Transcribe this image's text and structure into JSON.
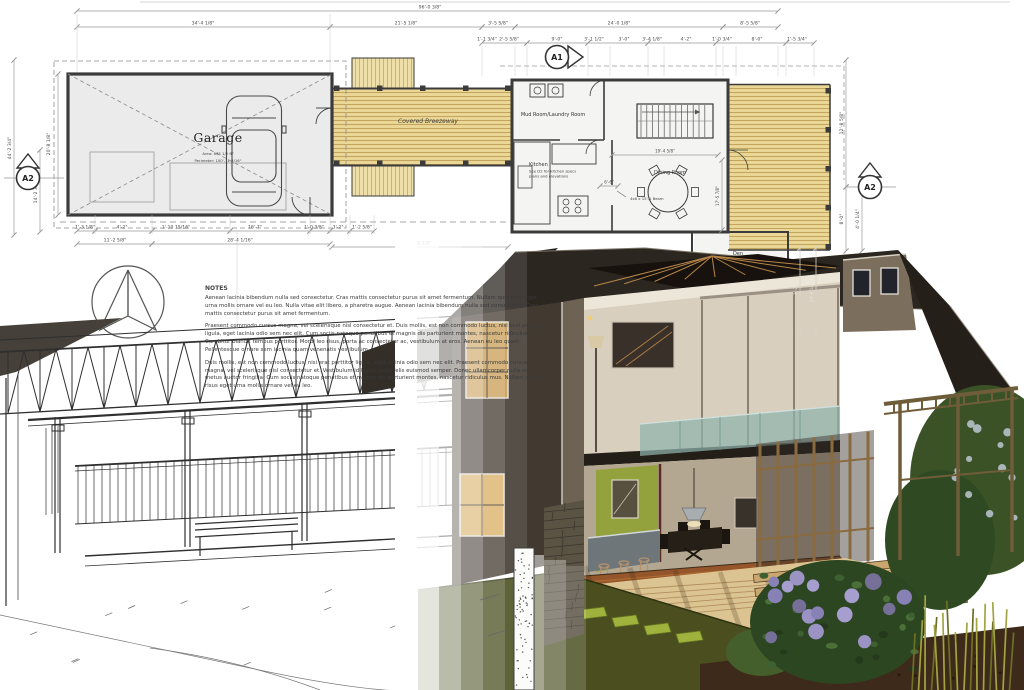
{
  "title": "Residential design: floor plan, construction sketch and 3D section render",
  "plan": {
    "garage": {
      "label": "Garage",
      "area": "Area: 635 1/2 ft²",
      "perimeter": "Perimeter: 100'-11 3/16\""
    },
    "breezeway_label": "Covered Breezeway",
    "rooms": {
      "mudroom": "Mud Room/Laundry Room",
      "kitchen": "Kitchen",
      "kitchen_note1": "See D2 for kitchen specs",
      "kitchen_note2": "plans and elevations",
      "dining": "Dining Room",
      "den": "Den"
    },
    "beam_note": "4x6 x 15'-1 Beam",
    "markers": {
      "a1": "A1",
      "a2_left": "A2",
      "a2_right": "A2"
    },
    "dims_top": [
      "96'-0 3/8\""
    ],
    "dims_row2": [
      "34'-4 1/8\"",
      "21'-5 1/8\"",
      "3'-5 5/8\"",
      "24'-0 1/8\"",
      "8'-5 5/8\""
    ],
    "dims_row3": [
      "1'-1 3/4\"",
      "2'-5 5/8\"",
      "9'-0\"",
      "3'-1 1/2\"",
      "3'-0\"",
      "3'-4 1/8\"",
      "4'-2\"",
      "1'-0 3/4\"",
      "8'-0\"",
      "1'-5 3/4\""
    ],
    "dims_bottom": [
      "1'-3 1/8\"",
      "4'-2\"",
      "1'-10 15/16\"",
      "16'-7\"",
      "1'-0 3/8\"",
      "3'-2\"",
      "1'-2 5/8\""
    ],
    "dims_bottom2": [
      "11'-2 5/8\"",
      "28'-4 1/16\"",
      "22'-5 1/8\""
    ],
    "dims_left": [
      "44'-2 3/4\"",
      "20'-8 1/8\"",
      "14'-2 3/4\""
    ],
    "dims_right": [
      "12'-8 5/8\"",
      "8'-0\"",
      "4'-0 1/4\"",
      "2'-2\"",
      "14'-0 1/2\""
    ],
    "dims_dining": [
      "19'-4 5/8\"",
      "17'-5 7/8\"",
      "6'-6\""
    ]
  },
  "notes": {
    "heading": "NOTES",
    "p1": "Aenean lacinia bibendum nulla sed consectetur. Cras mattis consectetur purus sit amet fermentum. Nullam quis risus eget urna mollis ornare vel eu leo. Nulla vitae elit libero, a pharetra augue. Aenean lacinia bibendum nulla sed consectetur. Cras mattis consectetur purus sit amet fermentum.",
    "p2": "Praesent commodo cursus magna, vel scelerisque nisl consectetur et. Duis mollis, est non commodo luctus, nisi erat porttitor ligula, eget lacinia odio sem nec elit. Cum sociis natoque penatibus et magnis dis parturient montes, nascetur ridiculus mus. Curabitur blandit tempus porttitor. Morbi leo risus, porta ac consectetur ac, vestibulum at eros. Aenean eu leo quam. Pellentesque ornare sem lacinia quam venenatis vestibulum.",
    "p3": "Duis mollis, est non commodo luctus, nisi erat porttitor ligula, eget lacinia odio sem nec elit. Praesent commodo cursus magna, vel scelerisque nisl consectetur et. Vestibulum id ligula porta felis euismod semper. Donec ullamcorper nulla non metus auctor fringilla. Cum sociis natoque penatibus et magnis dis parturient montes, nascetur ridiculus mus. Nullam quis risus eget urna mollis ornare vel eu leo."
  },
  "icons": [
    "north-arrow-icon",
    "section-marker-a1",
    "section-marker-a2"
  ],
  "colors": {
    "deck_wood": "#ead795",
    "deck_plank_line": "#c3a45f",
    "plan_fill": "#ebebeb",
    "wall_line": "#3b3b3b",
    "dim_line": "#9a9a9a",
    "render_roof": "#2b2620",
    "render_wall_dark": "#423a31",
    "interior_cream": "#d9cfbe",
    "accent_wall_green": "#93a23c",
    "floor_wood": "#94562a",
    "deck_render": "#dcc492",
    "pond_green": "#4b4f20",
    "stepping_stone": "#9fb23e",
    "plant_green": "#2c4621",
    "flower_purple": "#8781b6",
    "grass_yellow": "#a3a441",
    "stone_pier": "#5a5344",
    "glass_teal": "#8fb3ad"
  }
}
